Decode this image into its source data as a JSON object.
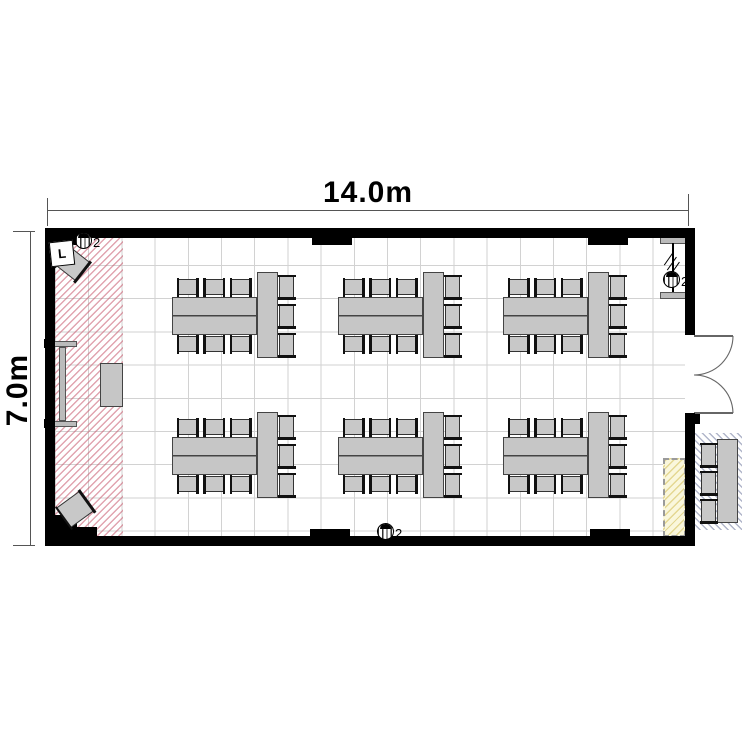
{
  "dimensions": {
    "width_label": "14.0m",
    "height_label": "7.0m"
  },
  "symbols": {
    "outlet_top_left_count": "2",
    "outlet_bottom_count": "2",
    "outlet_right_count": "2",
    "corner_unit_label": "L"
  },
  "colors": {
    "wall": "#000000",
    "furniture_fill": "#c6c6c6",
    "furniture_border": "#444444",
    "grid_line": "#d2d2d2",
    "stage_hatch": "#c85a6e",
    "annex_hatch": "#646e96",
    "counter_fill": "#faf7dc",
    "counter_hatch": "#d2be55",
    "dimension_line": "#555555"
  },
  "floor_plan": {
    "room": {
      "x": 45,
      "y": 228,
      "w": 650,
      "h": 318,
      "wall_thickness": 10
    },
    "walls": {
      "top": [
        45,
        228,
        650,
        10
      ],
      "bottom": [
        45,
        536,
        650,
        10
      ],
      "left": [
        45,
        228,
        10,
        318
      ],
      "right_upper": [
        685,
        228,
        10,
        107
      ],
      "right_lower": [
        685,
        413,
        10,
        133
      ]
    },
    "piers": [
      [
        45,
        228,
        45,
        17
      ],
      [
        312,
        228,
        40,
        17
      ],
      [
        588,
        228,
        40,
        17
      ],
      [
        310,
        529,
        40,
        17
      ],
      [
        590,
        529,
        40,
        17
      ]
    ],
    "corner_blocks": [
      [
        45,
        515,
        32,
        31
      ],
      [
        45,
        527,
        52,
        19
      ],
      [
        688,
        414,
        12,
        10
      ]
    ],
    "door": {
      "opening_y1": 335,
      "opening_y2": 413,
      "leaf_length": 39,
      "hinge_x": 694
    },
    "stage_hatch": [
      55,
      238,
      68,
      298
    ],
    "whiteboard": {
      "caps": [
        [
          47,
          341,
          30,
          6
        ],
        [
          47,
          421,
          30,
          6
        ]
      ],
      "bar": [
        58.5,
        347,
        7,
        74
      ],
      "nubs": [
        [
          44,
          339,
          5,
          9
        ],
        [
          44,
          419,
          5,
          9
        ]
      ]
    },
    "podium": [
      100,
      363,
      23,
      44
    ],
    "corner_chairs": [
      {
        "rect": [
          60,
          252,
          26,
          24
        ],
        "rotate": 38
      },
      {
        "rect": [
          60,
          497,
          30,
          25
        ],
        "rotate": -36
      }
    ],
    "partition_fixture": {
      "bars": [
        [
          660,
          237,
          27,
          6.5
        ],
        [
          660,
          292,
          27,
          6.5
        ]
      ],
      "vline": [
        672,
        243,
        1.5,
        49
      ],
      "ticks": [
        [
          661,
          258
        ],
        [
          664,
          263
        ],
        [
          667,
          268
        ]
      ]
    },
    "counter": [
      663,
      458,
      23,
      79
    ],
    "table_groups": {
      "columns_x": [
        172,
        338,
        503
      ],
      "rows_y": [
        272,
        412
      ],
      "h_table": {
        "dx": 0,
        "dy": 25,
        "w": 85,
        "h": 38
      },
      "v_table": {
        "dx": 85,
        "dy": 0,
        "w": 21,
        "h": 86
      },
      "chair_h": {
        "w": 21,
        "h": 16,
        "dx0": 5,
        "pitch": 26.5,
        "top_dy": 7,
        "bottom_dy": 64
      },
      "chair_v": {
        "w": 15,
        "h": 24,
        "dx": 107,
        "dy0": 3,
        "pitch": 29
      },
      "chairs_per_group": 9,
      "group_count": 6
    },
    "annex": {
      "hatch": [
        692,
        433,
        50,
        97
      ],
      "table": [
        717,
        439,
        21,
        84
      ],
      "chairs_x": 701,
      "chairs_y": [
        443,
        471,
        499
      ],
      "chair": {
        "w": 15,
        "h": 24
      }
    }
  }
}
